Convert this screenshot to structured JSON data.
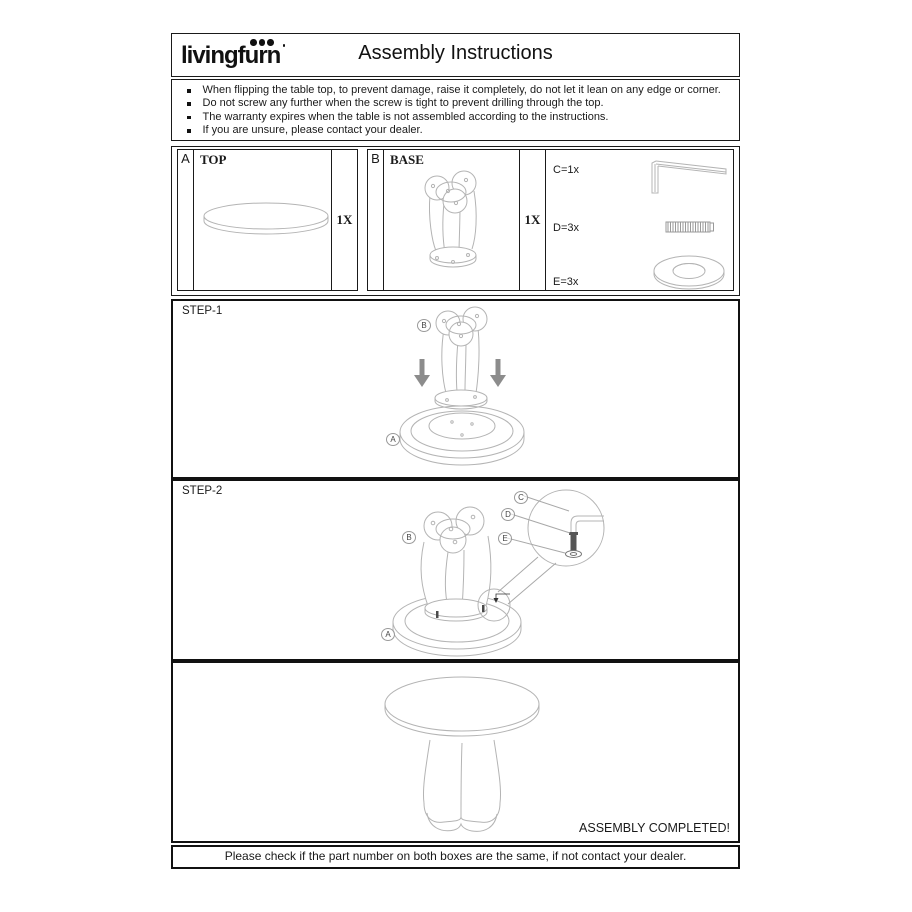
{
  "header": {
    "logo_text": "livingfurn",
    "title": "Assembly Instructions"
  },
  "warnings": [
    "When flipping the table top, to prevent damage, raise it completely, do not let it lean on any edge or corner.",
    "Do not screw any further when the screw is tight to prevent drilling through the top.",
    "The warranty expires when the table is not assembled according to the instructions.",
    "If you are unsure, please contact your dealer."
  ],
  "parts": {
    "a": {
      "letter": "A",
      "name": "TOP",
      "qty": "1X"
    },
    "b": {
      "letter": "B",
      "name": "BASE",
      "qty": "1X"
    },
    "hardware": {
      "c": {
        "label": "C=1x",
        "icon": "allen-key-icon"
      },
      "d": {
        "label": "D=3x",
        "icon": "screw-icon"
      },
      "e": {
        "label": "E=3x",
        "icon": "washer-icon"
      }
    }
  },
  "step1": {
    "title": "STEP-1",
    "label_a": "A",
    "label_b": "B"
  },
  "step2": {
    "title": "STEP-2",
    "label_a": "A",
    "label_b": "B",
    "label_c": "C",
    "label_d": "D",
    "label_e": "E"
  },
  "final": {
    "completed_text": "ASSEMBLY COMPLETED!"
  },
  "footer_note": "Please check if the part number on both boxes are the same, if not contact your dealer.",
  "colors": {
    "ink": "#1a1a1a",
    "sketch": "#b4b4b4",
    "arrow": "#8c8c8c"
  }
}
